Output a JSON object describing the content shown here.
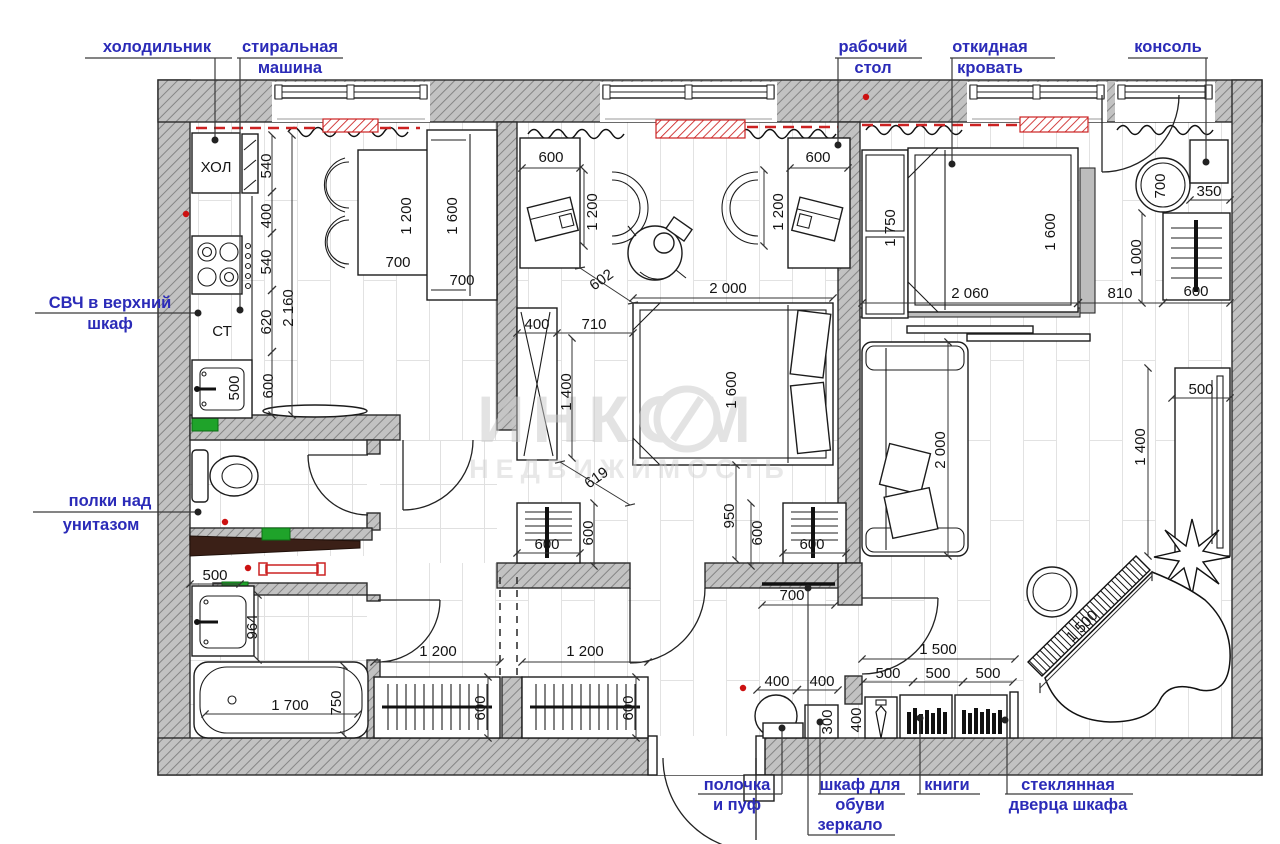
{
  "watermark": {
    "line1": "ИНКОМ",
    "line2": "НЕДВИЖИМОСТЬ"
  },
  "appliances": {
    "fridge_box": "ХОЛ",
    "countertop": "СТ"
  },
  "callouts": {
    "fridge": "холодильник",
    "washer_line1": "стиральная",
    "washer_line2": "машина",
    "microwave_line1": "СВЧ в верхний",
    "microwave_line2": "шкаф",
    "toilet_shelves_line1": "полки над",
    "toilet_shelves_line2": "унитазом",
    "work_desk_line1": "рабочий",
    "work_desk_line2": "стол",
    "fold_bed_line1": "откидная",
    "fold_bed_line2": "кровать",
    "console": "консоль",
    "pouf_line1": "полочка",
    "pouf_line2": "и пуф",
    "shoe_line1": "шкаф для",
    "shoe_line2": "обуви",
    "mirror": "зеркало",
    "books": "книги",
    "glass_door_line1": "стеклянная",
    "glass_door_line2": "дверца шкафа"
  },
  "dims": {
    "kitchen": {
      "chain": [
        "540",
        "400",
        "540",
        "620",
        "600"
      ],
      "total": "2 160",
      "sink": "500",
      "table_len": "1 200",
      "table_depth": "700",
      "bench_len": "1 600",
      "bench_depth": "700"
    },
    "kids": {
      "desk_left": "600",
      "chair_left": "1 200",
      "desk_right": "600",
      "chair_right": "1 200",
      "diag_pass": "602",
      "wardrobe_depth": "400",
      "wardrobe_gap": "710",
      "bed_len": "2 000",
      "bed_width": "1 600",
      "wardrobe_len": "1 400",
      "diag_bed": "619",
      "bed_to_wall": "950",
      "dresser_left": "600",
      "dresser_left_side": "600",
      "dresser_right": "600",
      "dresser_right_side": "600"
    },
    "bedroom": {
      "cabinet": "1 750",
      "bed_width": "1 600",
      "bed_len": "2 060",
      "gap_to_dresser": "810",
      "dresser_len": "1 000",
      "dresser_width": "600",
      "round_table": "700",
      "console_depth": "350"
    },
    "living": {
      "sofa": "2 000",
      "cabinet_width": "500",
      "cabinet_len": "1 400",
      "piano": "1 500"
    },
    "hall": {
      "wardrobe_left": "1 200",
      "wardrobe_left_depth": "600",
      "wardrobe_right": "1 200",
      "wardrobe_right_depth": "600",
      "mirror": "700",
      "pouf": "400",
      "shoe": "400",
      "shoe_depth": "300",
      "cabinets_total": "1 500",
      "cabinet_1": "500",
      "cabinet_2": "500",
      "cabinet_3": "500",
      "tie_cabinet_depth": "400"
    },
    "bathroom": {
      "sink": "500",
      "counter_len": "964",
      "tub_len": "1 700",
      "tub_width": "750"
    }
  },
  "colors": {
    "label": "#2b2bb8",
    "red_mark": "#cc2222",
    "green_mark": "#1fa32a",
    "wall": "#c2c2c2"
  }
}
